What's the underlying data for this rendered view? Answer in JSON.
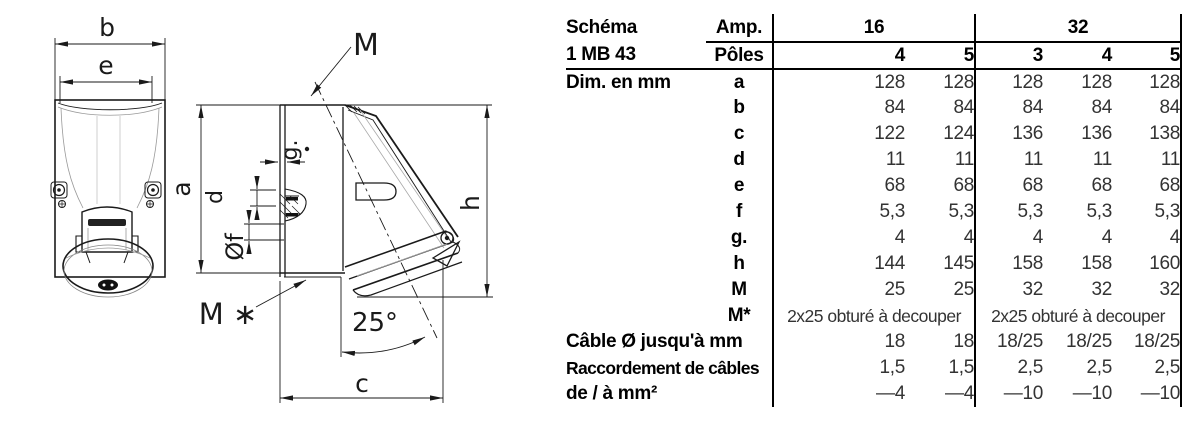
{
  "diagram": {
    "labels": {
      "b": "b",
      "e": "e",
      "M": "M",
      "a": "a",
      "g": "g.",
      "d": "d",
      "f": "Øf",
      "h": "h",
      "c": "c",
      "m_star": "M ∗",
      "angle": "25°"
    }
  },
  "table": {
    "schema_label": "Schéma",
    "schema_value": "1 MB 43",
    "amp_label": "Amp.",
    "poles_label": "Pôles",
    "amp_groups": [
      {
        "amp": "16",
        "poles": [
          "4",
          "5"
        ]
      },
      {
        "amp": "32",
        "poles": [
          "3",
          "4",
          "5"
        ]
      }
    ],
    "dim_section_label": "Dim. en mm",
    "dim_rows": [
      {
        "key": "a",
        "values": [
          "128",
          "128",
          "128",
          "128",
          "128"
        ]
      },
      {
        "key": "b",
        "values": [
          "84",
          "84",
          "84",
          "84",
          "84"
        ]
      },
      {
        "key": "c",
        "values": [
          "122",
          "124",
          "136",
          "136",
          "138"
        ]
      },
      {
        "key": "d",
        "values": [
          "11",
          "11",
          "11",
          "11",
          "11"
        ]
      },
      {
        "key": "e",
        "values": [
          "68",
          "68",
          "68",
          "68",
          "68"
        ]
      },
      {
        "key": "f",
        "values": [
          "5,3",
          "5,3",
          "5,3",
          "5,3",
          "5,3"
        ]
      },
      {
        "key": "g.",
        "values": [
          "4",
          "4",
          "4",
          "4",
          "4"
        ]
      },
      {
        "key": "h",
        "values": [
          "144",
          "145",
          "158",
          "158",
          "160"
        ]
      },
      {
        "key": "M",
        "values": [
          "25",
          "25",
          "32",
          "32",
          "32"
        ]
      }
    ],
    "m_star_row": {
      "key": "M*",
      "group_values": [
        "2x25 obturé à decouper",
        "2x25 obturé à decouper"
      ]
    },
    "extra_rows": [
      {
        "label": "Câble Ø jusqu'à mm",
        "values": [
          "18",
          "18",
          "18/25",
          "18/25",
          "18/25"
        ]
      },
      {
        "label": "Raccordement de câbles",
        "values": [
          "1,5",
          "1,5",
          "2,5",
          "2,5",
          "2,5"
        ]
      },
      {
        "label": "de / à mm²",
        "values": [
          "—4",
          "—4",
          "—10",
          "—10",
          "—10"
        ]
      }
    ]
  }
}
